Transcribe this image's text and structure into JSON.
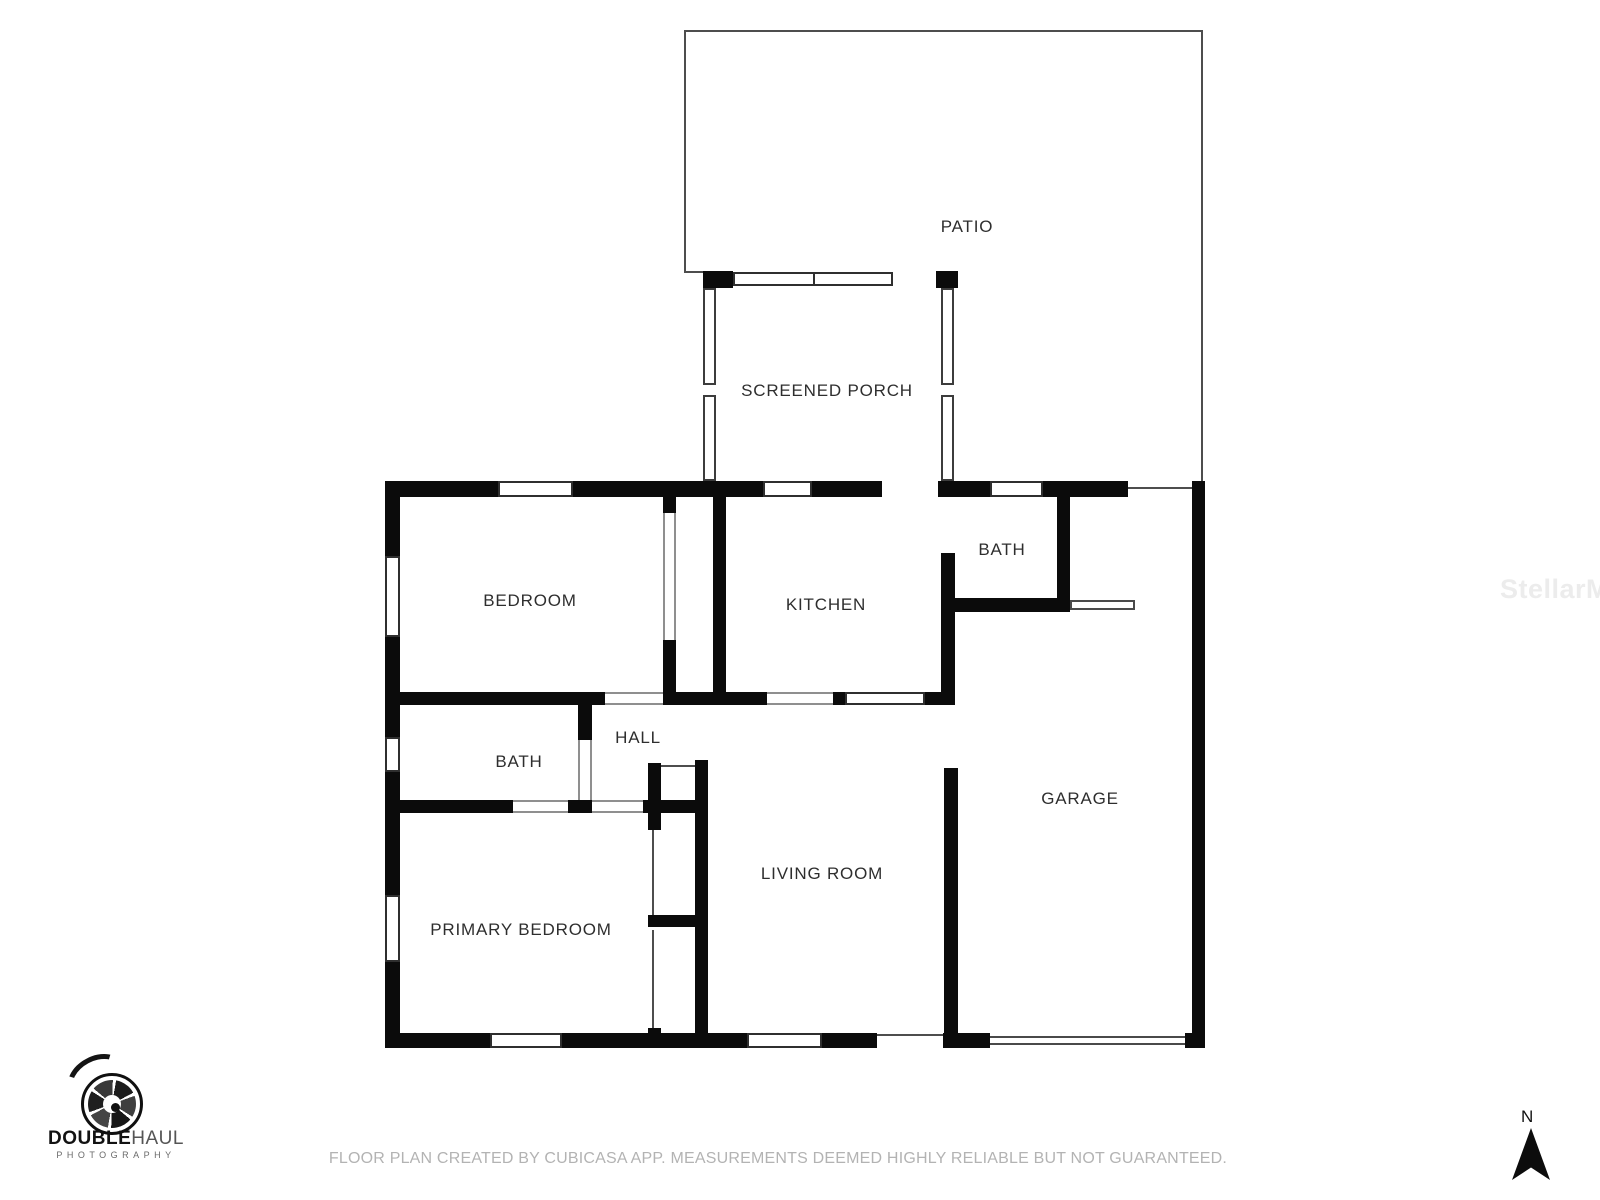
{
  "rooms": [
    {
      "id": "patio",
      "label": "PATIO"
    },
    {
      "id": "screened-porch",
      "label": "SCREENED PORCH"
    },
    {
      "id": "bedroom",
      "label": "BEDROOM"
    },
    {
      "id": "kitchen",
      "label": "KITCHEN"
    },
    {
      "id": "bath-upper",
      "label": "BATH"
    },
    {
      "id": "hall",
      "label": "HALL"
    },
    {
      "id": "bath-lower",
      "label": "BATH"
    },
    {
      "id": "primary-bedroom",
      "label": "PRIMARY BEDROOM"
    },
    {
      "id": "living-room",
      "label": "LIVING ROOM"
    },
    {
      "id": "garage",
      "label": "GARAGE"
    }
  ],
  "branding": {
    "logo_primary": "DOUBLE",
    "logo_secondary": "HAUL",
    "logo_subtitle": "PHOTOGRAPHY",
    "watermark": "StellarMLS"
  },
  "compass": {
    "label": "N"
  },
  "footer": {
    "disclaimer": "FLOOR PLAN CREATED BY CUBICASA APP. MEASUREMENTS DEEMED HIGHLY RELIABLE BUT NOT GUARANTEED."
  },
  "colors": {
    "wall": "#0b0b0b",
    "outline": "#4d4d4d",
    "label": "#2e2e2e",
    "footer_text": "#b3b3b3",
    "watermark": "#ececec"
  }
}
